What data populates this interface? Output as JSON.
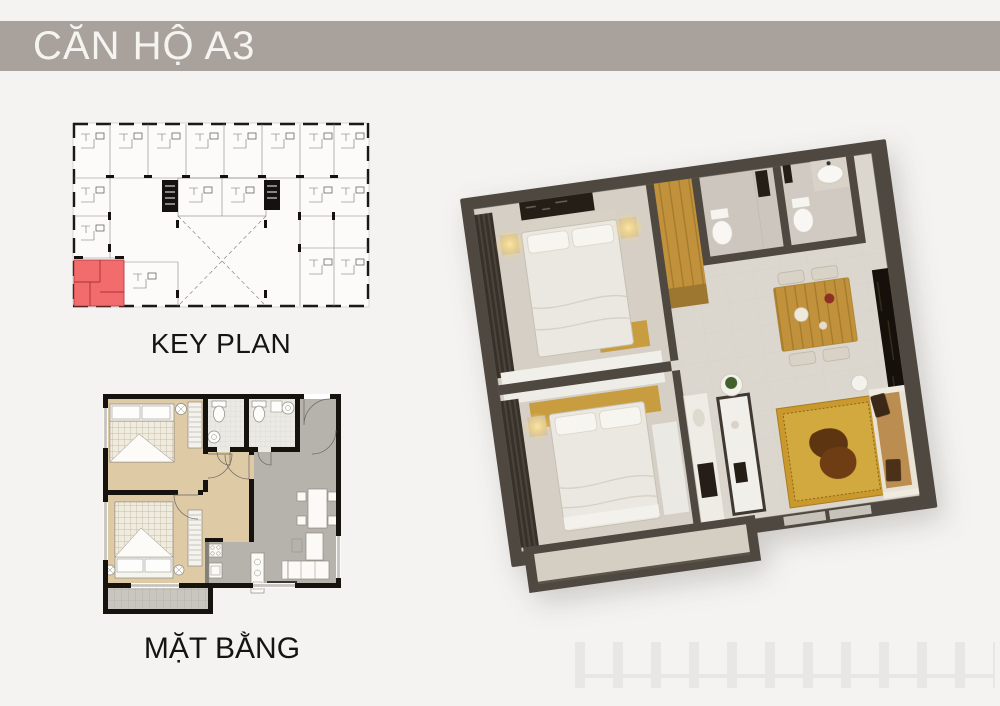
{
  "banner": {
    "title": "CĂN HỘ A3"
  },
  "key_plan": {
    "label": "KEY PLAN",
    "highlighted_unit_position": "bottom-left"
  },
  "floor_plan_2d": {
    "label": "MẶT BẰNG"
  },
  "colors": {
    "page_bg": "#f4f3f1",
    "banner_bg": "#a8a19c",
    "banner_text": "#f6f4f1",
    "highlight_red": "#f26b6d",
    "plan_wall": "#16130f",
    "bedroom_floor_2d": "#dfcaa6",
    "living_floor_2d": "#b6b2ac",
    "bath_floor_2d": "#ebe9e4",
    "balcony_floor_2d": "#c9c6c0",
    "wall_3d": "#4f4840",
    "floor_3d": "#dcd7ce",
    "bedroom_floor_3d": "#d5cfc5",
    "wood": "#c2913c",
    "gold": "#c79d3f",
    "rug": "#c9992e",
    "bed_white": "#ebe8e1",
    "sofa_tan": "#bb8d51",
    "dark_furniture": "#241e17",
    "coffee_table": "#5e3511",
    "lamp_glow": "#ffd878"
  }
}
